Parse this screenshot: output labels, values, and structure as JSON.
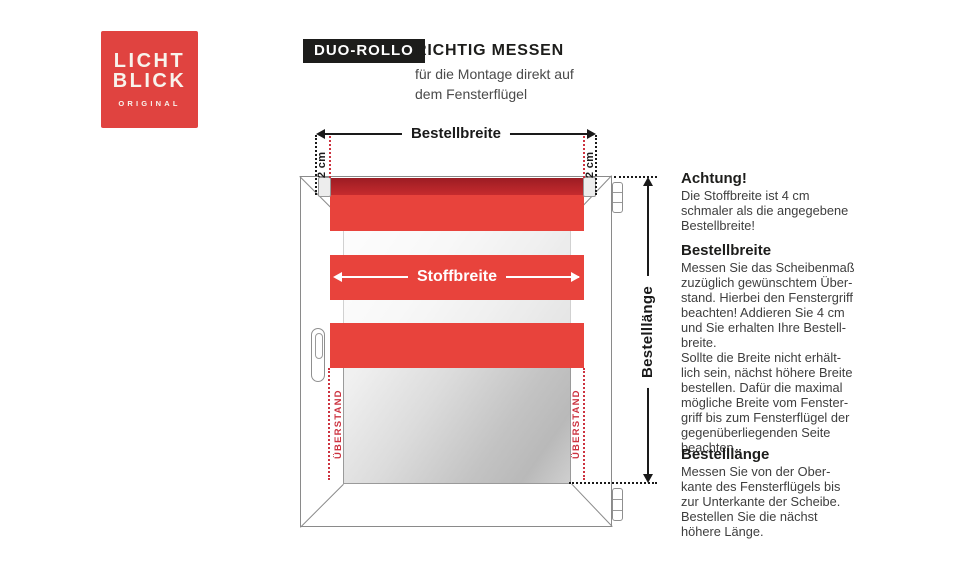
{
  "brand": {
    "line1": "LICHT",
    "line2": "BLICK",
    "tagline": "ORIGINAL"
  },
  "header": {
    "badge": "DUO-ROLLO",
    "title": "RICHTIG MESSEN",
    "subtitle": "für die Montage direkt auf\ndem Fensterflügel"
  },
  "diagram": {
    "bestellbreite_label": "Bestellbreite",
    "stoffbreite_label": "Stoffbreite",
    "bestelllaenge_label": "Bestelllänge",
    "two_cm": "2 cm",
    "ueberstand": "ÜBERSTAND"
  },
  "instructions": {
    "sections": [
      {
        "heading": "Achtung!",
        "body": "Die Stoffbreite ist 4 cm\nschmaler als die angegebene\nBestellbreite!"
      },
      {
        "heading": "Bestellbreite",
        "body": "Messen Sie das Scheibenmaß\nzuzüglich gewünschtem Über-\nstand. Hierbei den Fenstergriff\nbeachten! Addieren Sie 4 cm\nund Sie erhalten Ihre Bestell-\nbreite.\nSollte die Breite nicht erhält-\nlich sein, nächst höhere Breite\nbestellen. Dafür die maximal\nmögliche Breite vom Fenster-\ngriff bis zum Fensterflügel der\ngegenüberliegenden Seite\nbeachten."
      },
      {
        "heading": "Bestelllänge",
        "body": "Messen Sie von der Ober-\nkante des Fensterflügels bis\nzur Unterkante der Scheibe.\nBestellen Sie die nächst\nhöhere Länge."
      }
    ]
  },
  "colors": {
    "brand_red": "#E04340",
    "fabric_red": "#E8433C",
    "roller_dark_red": "#A82026",
    "dotted_red": "#CC3340",
    "badge_black": "#1D1D1B"
  }
}
